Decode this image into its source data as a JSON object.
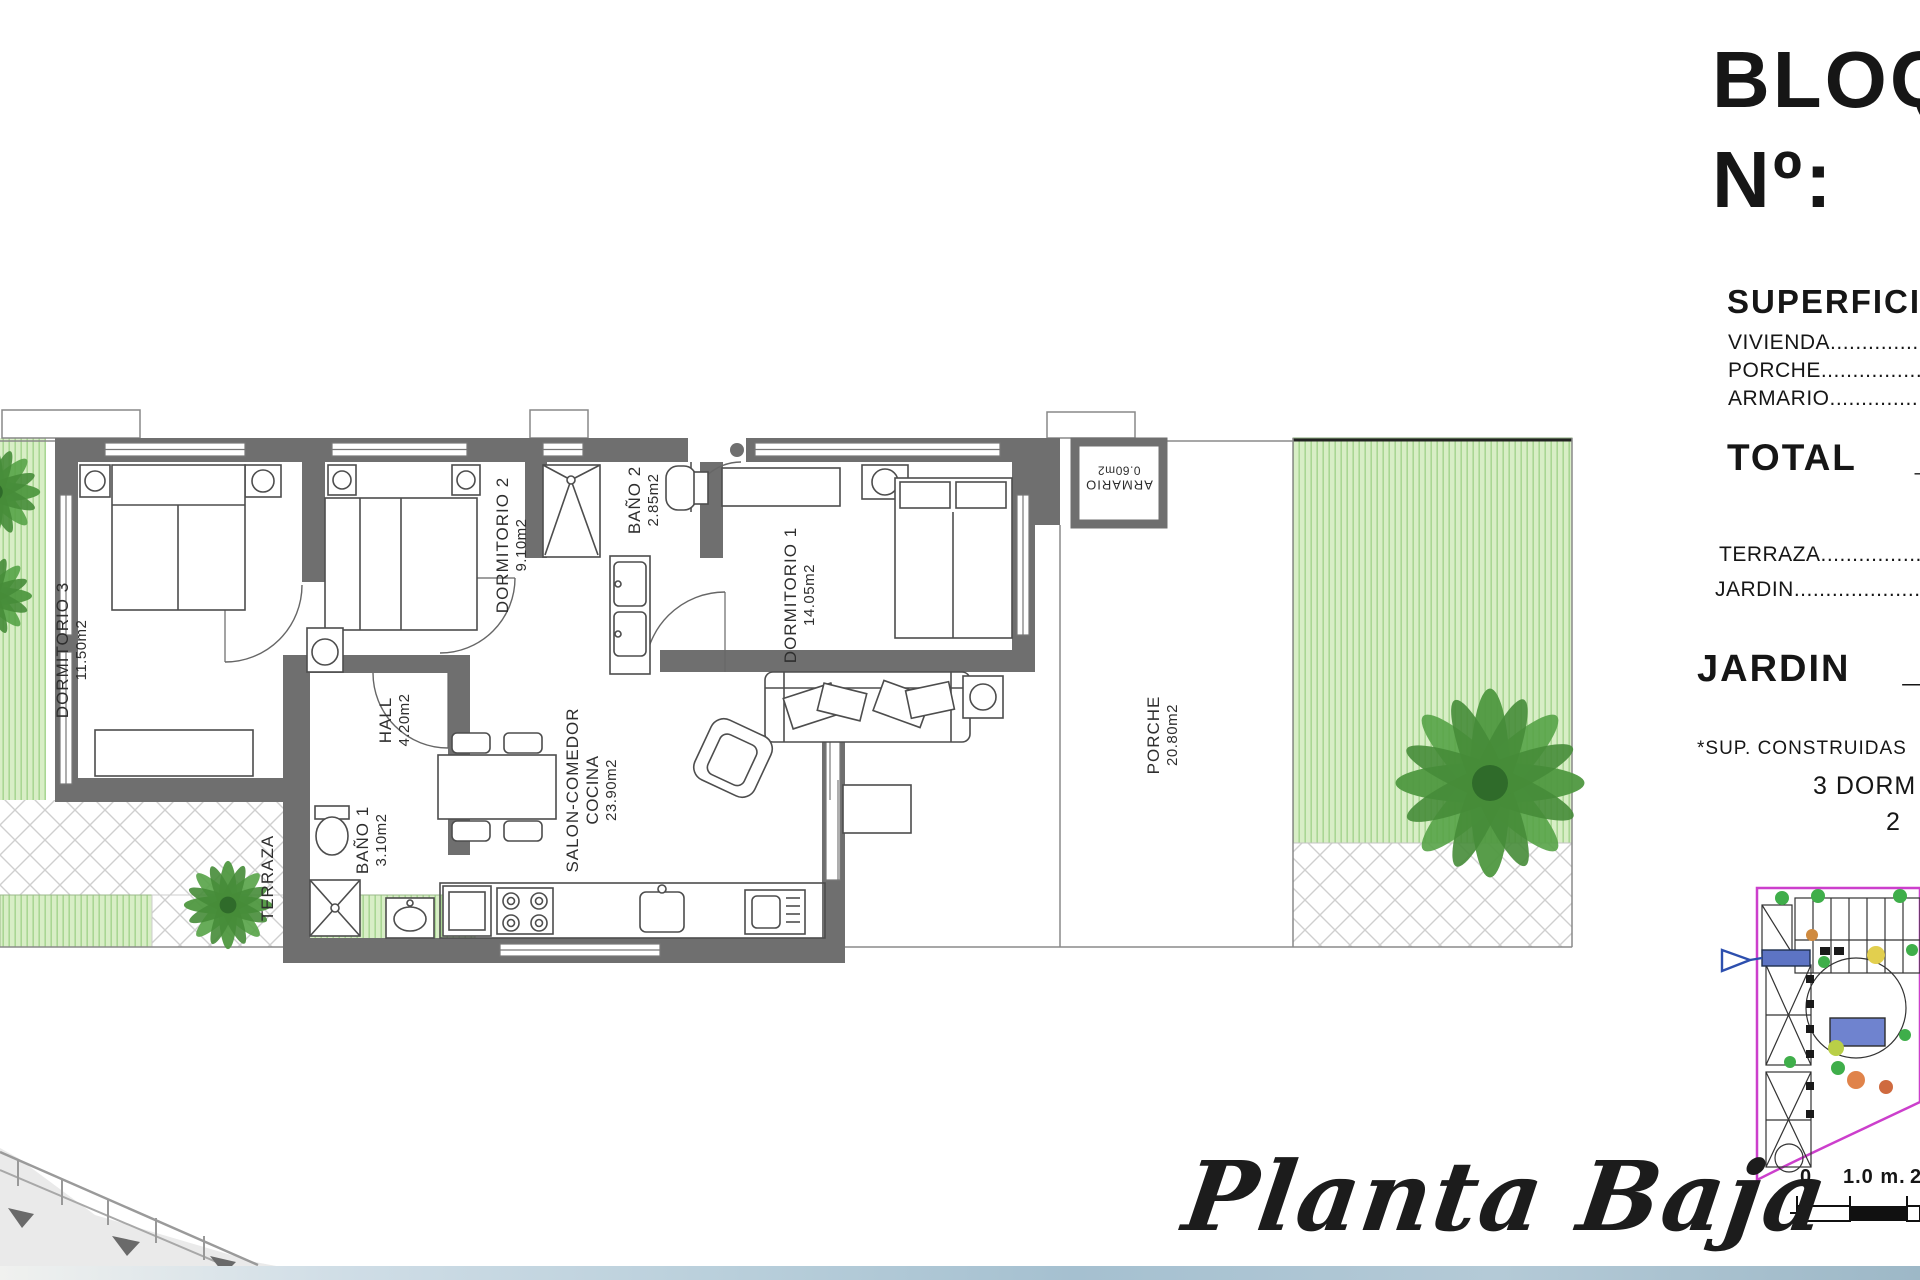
{
  "header": {
    "block": "BLOQ",
    "number": "Nº:"
  },
  "surfaces": {
    "title": "SUPERFICIE",
    "vivienda": "VIVIENDA........................................",
    "porche": "PORCHE.........................................",
    "armario": "ARMARIO........................................",
    "total_label": "TOTAL",
    "total_sep": "_",
    "total_value": "1",
    "terraza": "TERRAZA..................................",
    "jardin": "JARDIN.....................................",
    "jardin_total_label": "JARDIN",
    "jardin_total_sep": "_",
    "jardin_total_value": "2",
    "footnote": "*SUP. CONSTRUIDAS",
    "note_dorms": "3 DORM",
    "note_value": "2"
  },
  "rooms": {
    "dormitorio3": {
      "name": "DORMITORIO 3",
      "area": "11.50m2"
    },
    "dormitorio2": {
      "name": "DORMITORIO 2",
      "area": "9.10m2"
    },
    "bano2": {
      "name": "BAÑO 2",
      "area": "2.85m2"
    },
    "dormitorio1": {
      "name": "DORMITORIO 1",
      "area": "14.05m2"
    },
    "hall": {
      "name": "HALL",
      "area": "4.20m2"
    },
    "bano1": {
      "name": "BAÑO 1",
      "area": "3.10m2"
    },
    "salon": {
      "name": "SALON-COMEDOR",
      "name2": "COCINA",
      "area": "23.90m2"
    },
    "terraza": {
      "name": "TERRAZA"
    },
    "porche": {
      "name": "PORCHE",
      "area": "20.80m2"
    },
    "armario": {
      "name": "ARMARIO",
      "area": "0.60m2"
    }
  },
  "plan_title": "Planta Baja",
  "scale_bar": {
    "zero": "0",
    "one_m": "1.0 m.",
    "two": "2"
  },
  "colors": {
    "wall": "#6f6f6f",
    "garden_base": "#d8eec6",
    "garden_stripe": "#a9d693",
    "site_border": "#cc3fcc",
    "pool": "#6f83cf",
    "highlight_block": "#5d74c4",
    "bottom_band": "#b9cfdb"
  }
}
